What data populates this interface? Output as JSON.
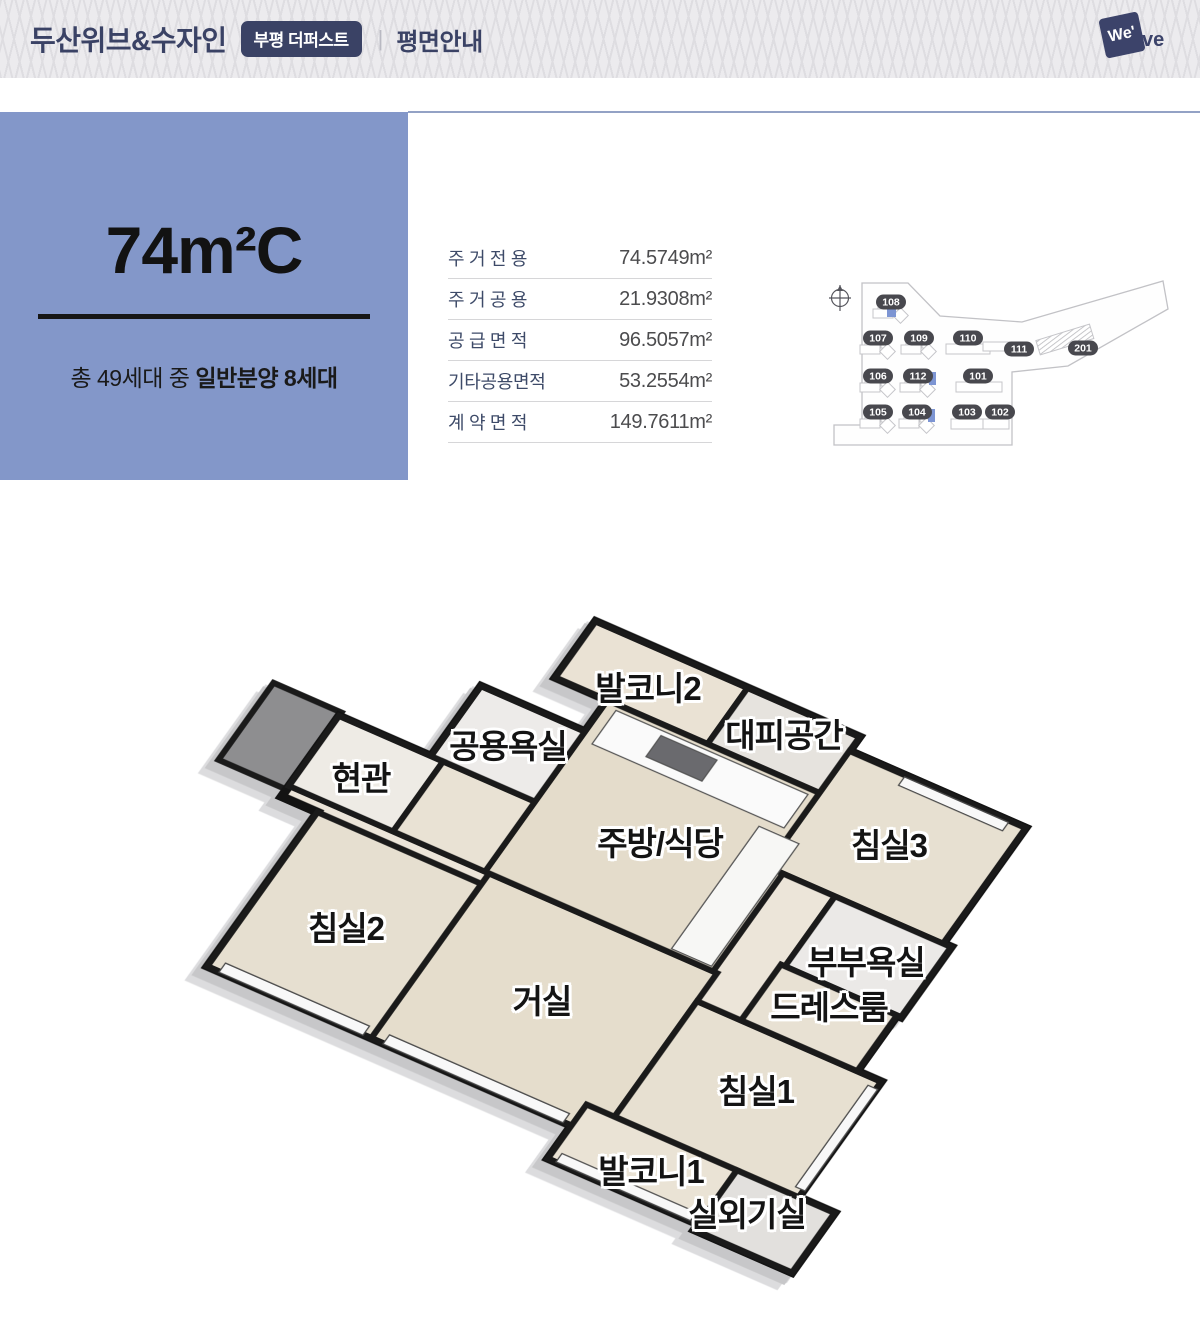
{
  "header": {
    "title": "두산위브&수자인",
    "badge": "부평 더퍼스트",
    "divider": "|",
    "page_title": "평면안내",
    "logo": {
      "box_text": "We'",
      "tail_text": "ve"
    }
  },
  "unit_panel": {
    "type_name": "74m²C",
    "note_prefix": "총 49세대 중 ",
    "note_bold": "일반분양 8세대",
    "panel_color": "#8397c9"
  },
  "area_table": {
    "rows": [
      {
        "label": "주 거 전 용",
        "value": "74.5749m²"
      },
      {
        "label": "주 거 공 용",
        "value": "21.9308m²"
      },
      {
        "label": "공 급 면 적",
        "value": "96.5057m²"
      },
      {
        "label": "기타공용면적",
        "value": "53.2554m²"
      },
      {
        "label": "계 약 면 적",
        "value": "149.7611m²"
      }
    ]
  },
  "site_map": {
    "compass_label": "N",
    "building_numbers": [
      "108",
      "107",
      "109",
      "110",
      "111",
      "201",
      "106",
      "112",
      "101",
      "105",
      "104",
      "103",
      "102"
    ],
    "badge_color": "#48484e",
    "highlight_color": "#7d95d3"
  },
  "floor_plan": {
    "room_labels": [
      "발코니2",
      "대피공간",
      "공용욕실",
      "현관",
      "주방/식당",
      "침실3",
      "침실2",
      "부부욕실",
      "드레스룸",
      "거실",
      "침실1",
      "발코니1",
      "실외기실"
    ]
  }
}
